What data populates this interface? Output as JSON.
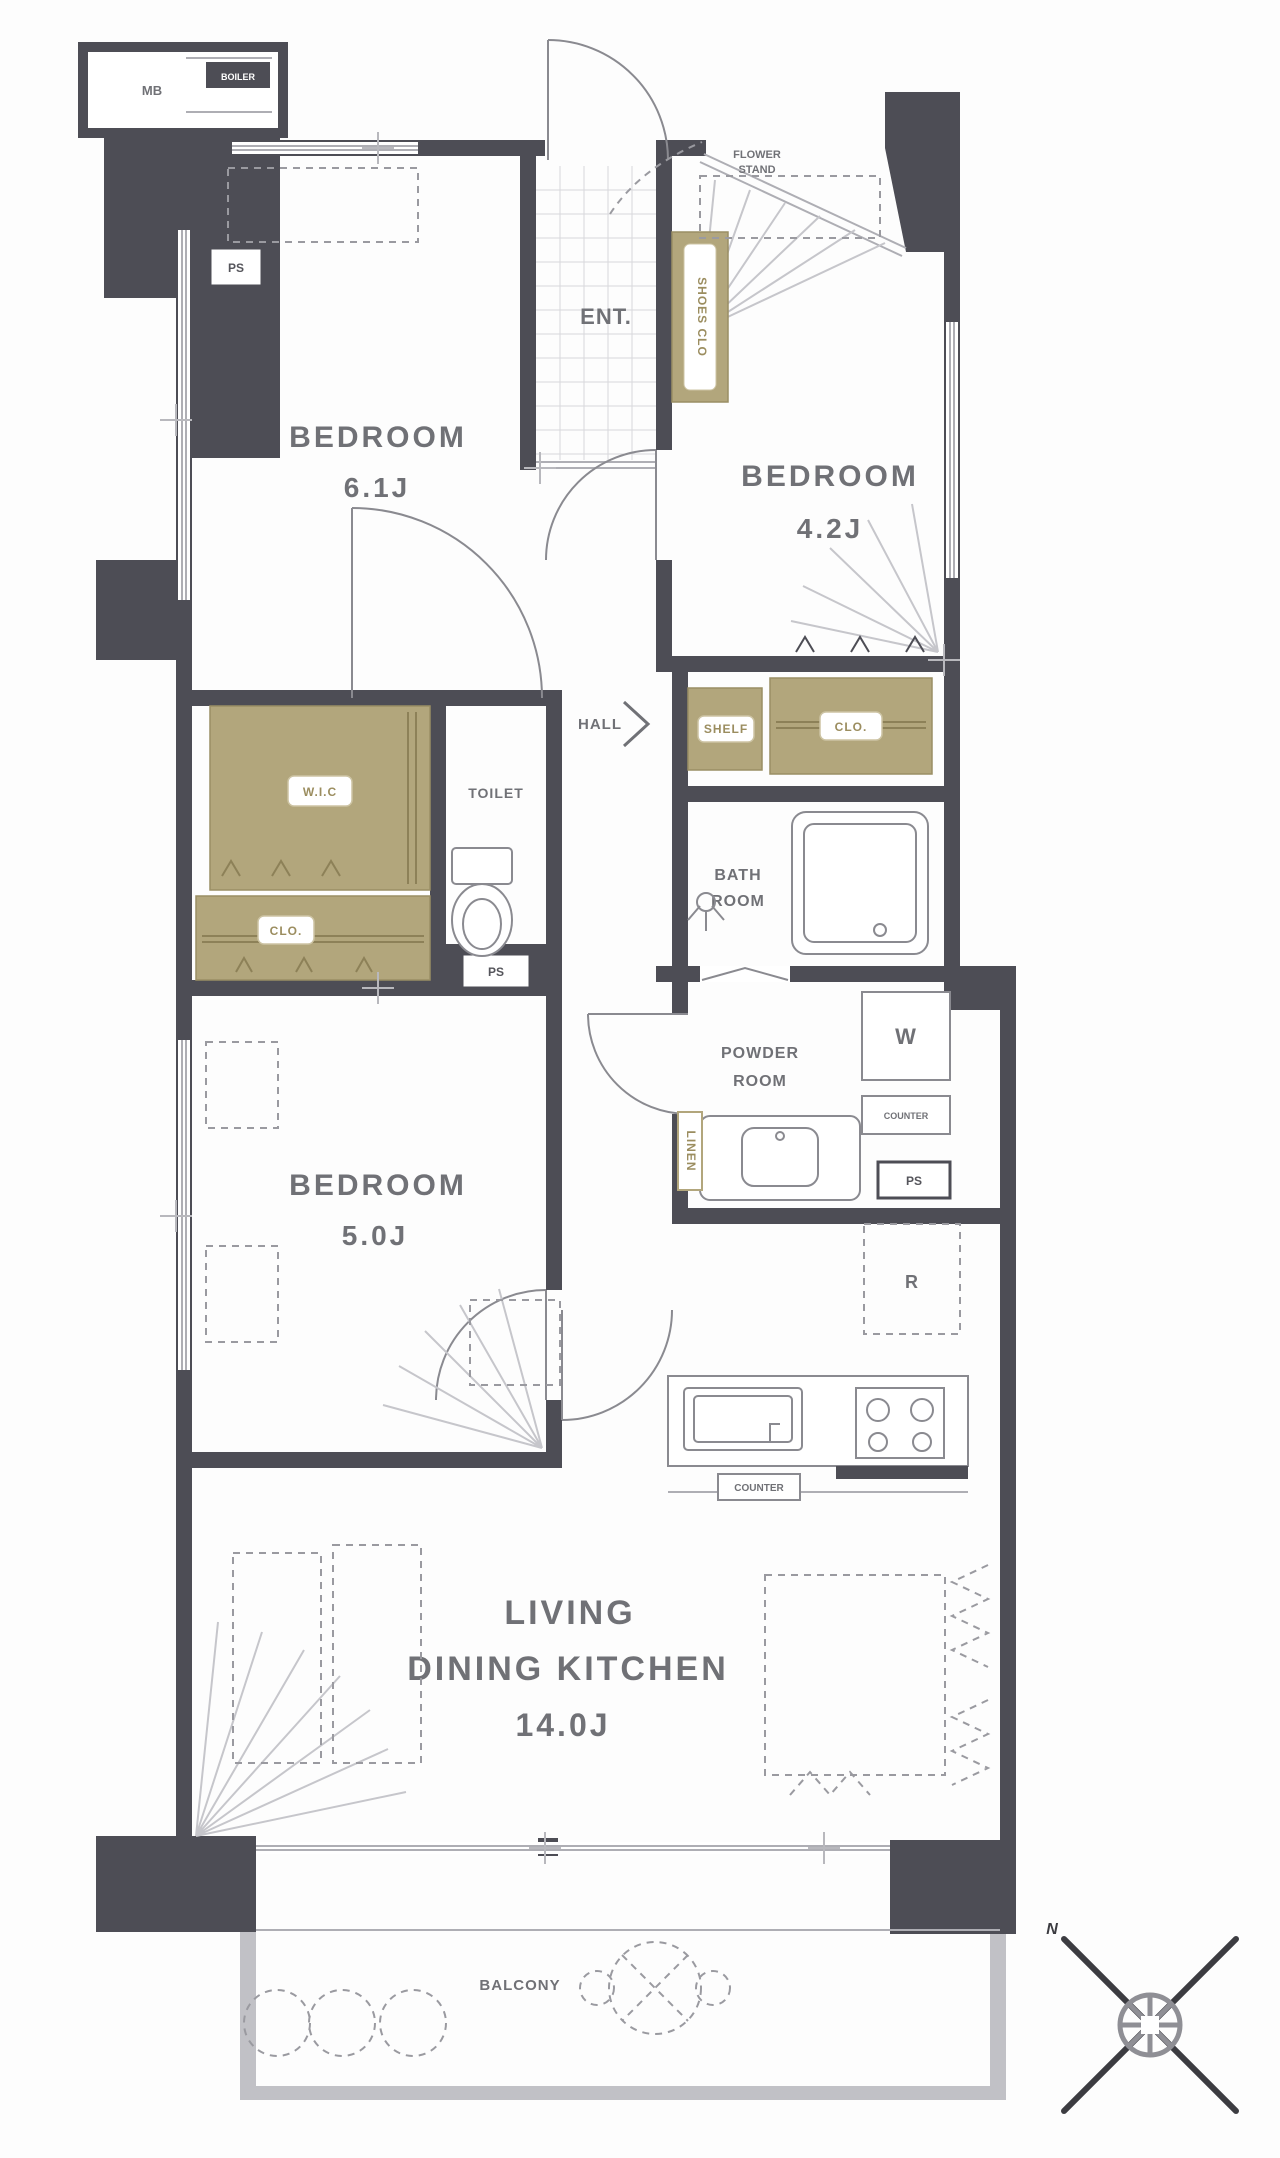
{
  "labels": {
    "mb": "MB",
    "boiler": "BOILER",
    "ps": "PS",
    "ent": "ENT.",
    "flower_stand_line1": "FLOWER",
    "flower_stand_line2": "STAND",
    "shoes_closet": "SHOES CLO",
    "hall": "HALL",
    "shelf": "SHELF",
    "closet": "CLO.",
    "walk_in_closet": "W.I.C",
    "toilet": "TOILET",
    "bath_line1": "BATH",
    "bath_line2": "ROOM",
    "powder_line1": "POWDER",
    "powder_line2": "ROOM",
    "washer": "W",
    "counter": "COUNTER",
    "fridge": "R",
    "linen": "LINEN",
    "balcony": "BALCONY",
    "north": "N"
  },
  "rooms": {
    "bedroom1": {
      "name": "BEDROOM",
      "size": "6.1J"
    },
    "bedroom2": {
      "name": "BEDROOM",
      "size": "4.2J"
    },
    "bedroom3": {
      "name": "BEDROOM",
      "size": "5.0J"
    },
    "ldk": {
      "line1": "LIVING",
      "line2": "DINING KITCHEN",
      "size": "14.0J"
    }
  },
  "colors": {
    "wall": "#4d4d55",
    "closet_fill": "#b2a67c",
    "closet_line": "#8d8158",
    "text": "#707176",
    "line": "#9a9aa2"
  }
}
